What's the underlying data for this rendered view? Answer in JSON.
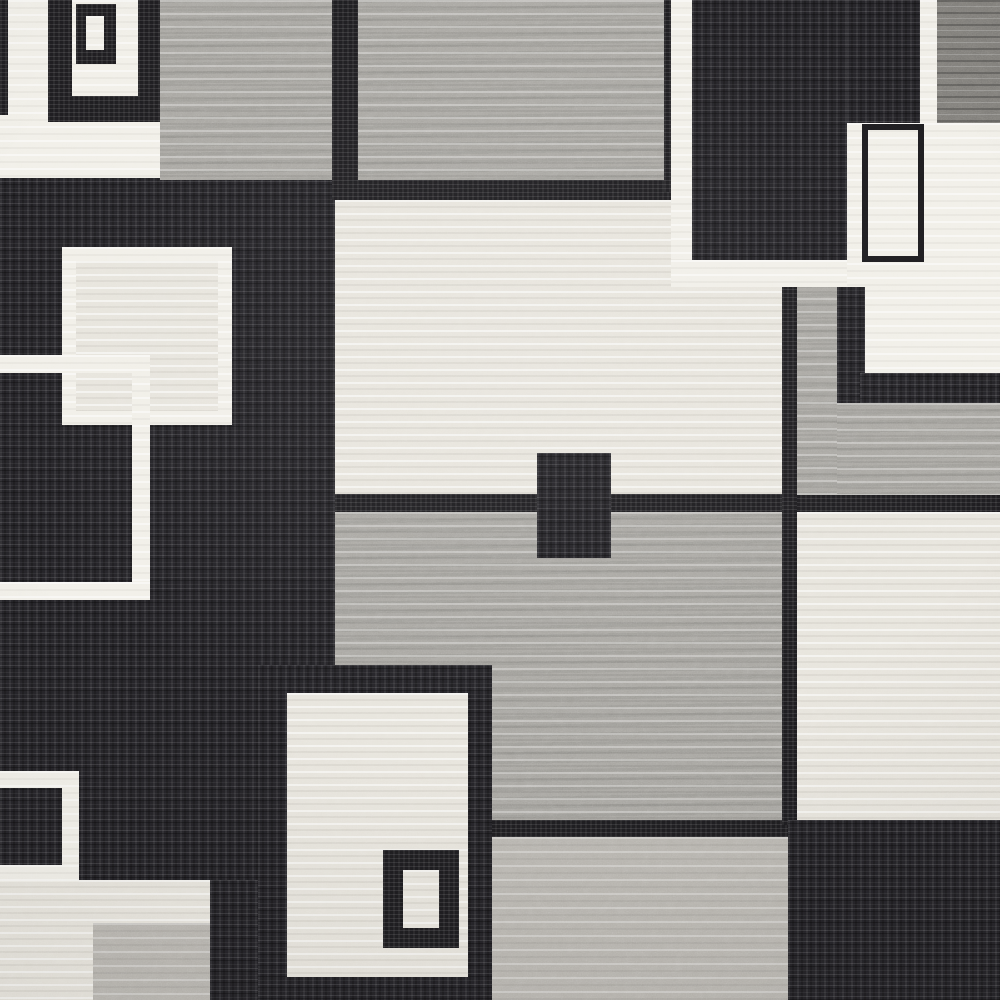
{
  "image": {
    "type": "photograph",
    "subject": "Top-down close-up of a modern geometric area rug",
    "style": "Contemporary color-block pattern of overlapping squares, rectangles and square outlines",
    "canvas": {
      "width": 1000,
      "height": 1000
    },
    "palette": {
      "black": "#242327",
      "charcoal": "#1d1c1f",
      "darkgray": "#7e7c78",
      "gray": "#a7a5a0",
      "graylight": "#b8b5af",
      "ivory": "#e7e4dc",
      "white": "#f1efe8"
    }
  },
  "blocks": [
    {
      "n": "canvas-base",
      "x": 0,
      "y": 0,
      "w": 1000,
      "h": 1000,
      "t": "ivory"
    },
    {
      "n": "left-black-field",
      "x": 0,
      "y": 170,
      "w": 345,
      "h": 715,
      "t": "black"
    },
    {
      "n": "bottom-left-ivory-block",
      "x": 0,
      "y": 880,
      "w": 215,
      "h": 120,
      "t": "ivory"
    },
    {
      "n": "bottom-left-lightgray-block",
      "x": 93,
      "y": 923,
      "w": 124,
      "h": 77,
      "t": "graylight"
    },
    {
      "n": "bottom-left-black-strip",
      "x": 210,
      "y": 880,
      "w": 80,
      "h": 120,
      "t": "black"
    },
    {
      "n": "topleft-white-field",
      "x": 0,
      "y": 0,
      "w": 160,
      "h": 178,
      "t": "white"
    },
    {
      "n": "topleft-edge-dark-sliver",
      "x": 0,
      "y": 0,
      "w": 8,
      "h": 115,
      "t": "charcoal"
    },
    {
      "n": "topleft-square-frame",
      "x": 48,
      "y": 0,
      "w": 112,
      "h": 122,
      "t": "charcoal"
    },
    {
      "n": "topleft-square-inner-white",
      "x": 72,
      "y": 0,
      "w": 66,
      "h": 96,
      "t": "white"
    },
    {
      "n": "topleft-small-square-frame",
      "x": 76,
      "y": 4,
      "w": 40,
      "h": 60,
      "t": "charcoal"
    },
    {
      "n": "topleft-small-square-center",
      "x": 86,
      "y": 16,
      "w": 18,
      "h": 34,
      "t": "white"
    },
    {
      "n": "top-gray-block-left",
      "x": 160,
      "y": 0,
      "w": 172,
      "h": 180,
      "t": "gray"
    },
    {
      "n": "top-dark-divider",
      "x": 332,
      "y": 0,
      "w": 26,
      "h": 180,
      "t": "charcoal"
    },
    {
      "n": "top-gray-block-right",
      "x": 358,
      "y": 0,
      "w": 310,
      "h": 185,
      "t": "gray"
    },
    {
      "n": "top-dark-strip",
      "x": 332,
      "y": 180,
      "w": 340,
      "h": 20,
      "t": "charcoal"
    },
    {
      "n": "center-ivory-field",
      "x": 335,
      "y": 200,
      "w": 447,
      "h": 297,
      "t": "ivory"
    },
    {
      "n": "mid-dark-hstrip",
      "x": 335,
      "y": 494,
      "w": 665,
      "h": 18,
      "t": "charcoal"
    },
    {
      "n": "center-gray-field",
      "x": 335,
      "y": 512,
      "w": 453,
      "h": 310,
      "t": "gray"
    },
    {
      "n": "center-small-dark-rect",
      "x": 537,
      "y": 453,
      "w": 74,
      "h": 105,
      "t": "black"
    },
    {
      "n": "lower-dark-hstrip",
      "x": 490,
      "y": 820,
      "w": 298,
      "h": 17,
      "t": "charcoal"
    },
    {
      "n": "bottom-center-gray-block",
      "x": 490,
      "y": 837,
      "w": 298,
      "h": 163,
      "t": "graylight"
    },
    {
      "n": "bottom-motif-frame",
      "x": 258,
      "y": 665,
      "w": 234,
      "h": 335,
      "t": "black"
    },
    {
      "n": "bottom-motif-interior",
      "x": 287,
      "y": 693,
      "w": 181,
      "h": 284,
      "t": "ivory"
    },
    {
      "n": "bottom-motif-small-frame",
      "x": 383,
      "y": 850,
      "w": 76,
      "h": 98,
      "t": "charcoal"
    },
    {
      "n": "bottom-motif-small-center",
      "x": 403,
      "y": 870,
      "w": 36,
      "h": 58,
      "t": "ivory"
    },
    {
      "n": "right-dark-vline",
      "x": 782,
      "y": 285,
      "w": 15,
      "h": 540,
      "t": "charcoal"
    },
    {
      "n": "right-ivory-block",
      "x": 797,
      "y": 512,
      "w": 203,
      "h": 311,
      "t": "ivory"
    },
    {
      "n": "bottom-right-black-block",
      "x": 788,
      "y": 820,
      "w": 212,
      "h": 180,
      "t": "black"
    },
    {
      "n": "right-gray-column",
      "x": 797,
      "y": 285,
      "w": 40,
      "h": 210,
      "t": "gray"
    },
    {
      "n": "right-L-frame-vertical",
      "x": 837,
      "y": 283,
      "w": 28,
      "h": 122,
      "t": "black"
    },
    {
      "n": "right-white-pocket",
      "x": 865,
      "y": 283,
      "w": 135,
      "h": 92,
      "t": "white"
    },
    {
      "n": "right-L-frame-horizontal",
      "x": 860,
      "y": 373,
      "w": 140,
      "h": 30,
      "t": "black"
    },
    {
      "n": "right-gray-below-L",
      "x": 837,
      "y": 403,
      "w": 163,
      "h": 92,
      "t": "gray"
    },
    {
      "n": "topright-black-square",
      "x": 692,
      "y": 0,
      "w": 155,
      "h": 262,
      "t": "black"
    },
    {
      "n": "topright-black-square-ext",
      "x": 847,
      "y": 0,
      "w": 73,
      "h": 125,
      "t": "black"
    },
    {
      "n": "topright-frame-outer-dark-line",
      "x": 664,
      "y": 0,
      "w": 7,
      "h": 192,
      "t": "charcoal"
    },
    {
      "n": "topright-white-frame-left",
      "x": 671,
      "y": 0,
      "w": 21,
      "h": 287,
      "t": "white"
    },
    {
      "n": "topright-white-frame-bottom",
      "x": 671,
      "y": 260,
      "w": 266,
      "h": 27,
      "t": "white"
    },
    {
      "n": "topright-white-strip",
      "x": 920,
      "y": 0,
      "w": 17,
      "h": 125,
      "t": "white"
    },
    {
      "n": "topright-darkgray-corner",
      "x": 937,
      "y": 0,
      "w": 63,
      "h": 123,
      "t": "darkgray"
    },
    {
      "n": "topright-ivory-block",
      "x": 847,
      "y": 123,
      "w": 153,
      "h": 164,
      "t": "white"
    },
    {
      "n": "topright-outlined-rect",
      "x": 862,
      "y": 124,
      "w": 62,
      "h": 138,
      "t": "none",
      "bw": 6,
      "bc": "charcoal"
    },
    {
      "n": "left-ivory-square-border",
      "x": 62,
      "y": 247,
      "w": 170,
      "h": 178,
      "t": "white"
    },
    {
      "n": "left-ivory-square-interior",
      "x": 76,
      "y": 261,
      "w": 142,
      "h": 150,
      "t": "ivory"
    },
    {
      "n": "left-outline-square-top",
      "x": 0,
      "y": 355,
      "w": 150,
      "h": 18,
      "t": "white"
    },
    {
      "n": "left-outline-square-right",
      "x": 132,
      "y": 355,
      "w": 18,
      "h": 245,
      "t": "white"
    },
    {
      "n": "left-outline-square-bottom",
      "x": 0,
      "y": 582,
      "w": 150,
      "h": 18,
      "t": "white"
    },
    {
      "n": "bottomleft-white-frame-top",
      "x": 0,
      "y": 771,
      "w": 79,
      "h": 17,
      "t": "white"
    },
    {
      "n": "bottomleft-white-frame-right",
      "x": 62,
      "y": 771,
      "w": 17,
      "h": 111,
      "t": "white"
    },
    {
      "n": "bottomleft-white-frame-bottom",
      "x": 0,
      "y": 865,
      "w": 79,
      "h": 17,
      "t": "white"
    }
  ]
}
